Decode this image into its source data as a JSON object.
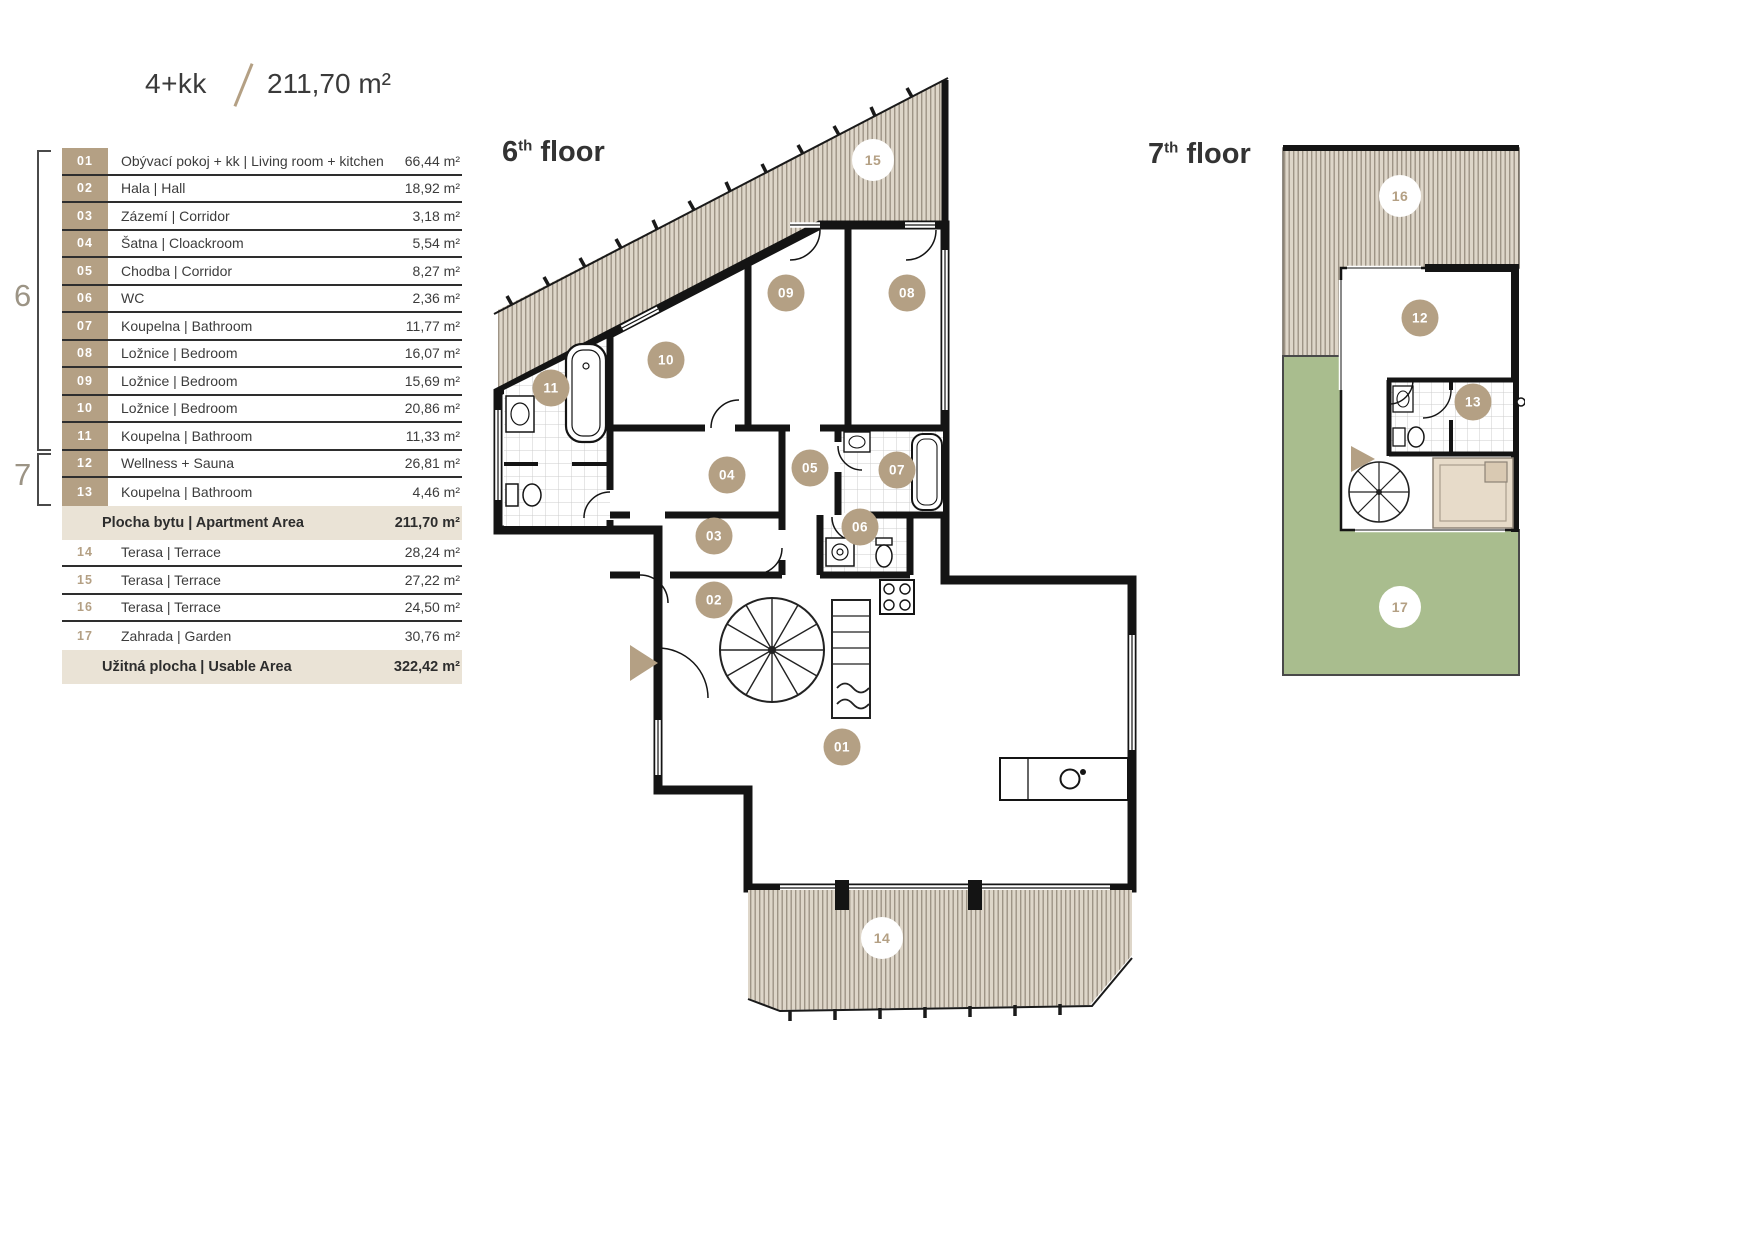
{
  "header": {
    "layout_type": "4+kk",
    "total_area": "211,70 m²"
  },
  "legend": {
    "bracket6": "6",
    "bracket7": "7",
    "rooms": [
      {
        "num": "01",
        "name": "Obývací pokoj + kk | Living room + kitchen",
        "area": "66,44 m²"
      },
      {
        "num": "02",
        "name": "Hala | Hall",
        "area": "18,92 m²"
      },
      {
        "num": "03",
        "name": "Zázemí | Corridor",
        "area": "3,18 m²"
      },
      {
        "num": "04",
        "name": "Šatna | Cloackroom",
        "area": "5,54 m²"
      },
      {
        "num": "05",
        "name": "Chodba | Corridor",
        "area": "8,27 m²"
      },
      {
        "num": "06",
        "name": "WC",
        "area": "2,36 m²"
      },
      {
        "num": "07",
        "name": "Koupelna | Bathroom",
        "area": "11,77 m²"
      },
      {
        "num": "08",
        "name": "Ložnice | Bedroom",
        "area": "16,07 m²"
      },
      {
        "num": "09",
        "name": "Ložnice | Bedroom",
        "area": "15,69 m²"
      },
      {
        "num": "10",
        "name": "Ložnice | Bedroom",
        "area": "20,86 m²"
      },
      {
        "num": "11",
        "name": "Koupelna | Bathroom",
        "area": "11,33 m²"
      },
      {
        "num": "12",
        "name": "Wellness + Sauna",
        "area": "26,81 m²"
      },
      {
        "num": "13",
        "name": "Koupelna | Bathroom",
        "area": "4,46 m²"
      }
    ],
    "apartment_total": {
      "label": "Plocha bytu | Apartment Area",
      "area": "211,70 m²"
    },
    "outdoor": [
      {
        "num": "14",
        "name": "Terasa | Terrace",
        "area": "28,24 m²"
      },
      {
        "num": "15",
        "name": "Terasa | Terrace",
        "area": "27,22 m²"
      },
      {
        "num": "16",
        "name": "Terasa | Terrace",
        "area": "24,50 m²"
      },
      {
        "num": "17",
        "name": "Zahrada | Garden",
        "area": "30,76 m²"
      }
    ],
    "usable_total": {
      "label": "Užitná plocha | Usable Area",
      "area": "322,42 m²"
    }
  },
  "floor6": {
    "num": "6",
    "sup": "th",
    "word": "floor",
    "badges": [
      "15",
      "09",
      "08",
      "10",
      "11",
      "04",
      "05",
      "07",
      "03",
      "06",
      "02",
      "01",
      "14"
    ]
  },
  "floor7": {
    "num": "7",
    "sup": "th",
    "word": "floor",
    "badges": [
      "16",
      "12",
      "13",
      "17"
    ]
  },
  "colors": {
    "accent_tan": "#b4a084",
    "highlight_row": "#eae3d6",
    "garden_green": "#a9bd8e",
    "wall": "#141414"
  }
}
